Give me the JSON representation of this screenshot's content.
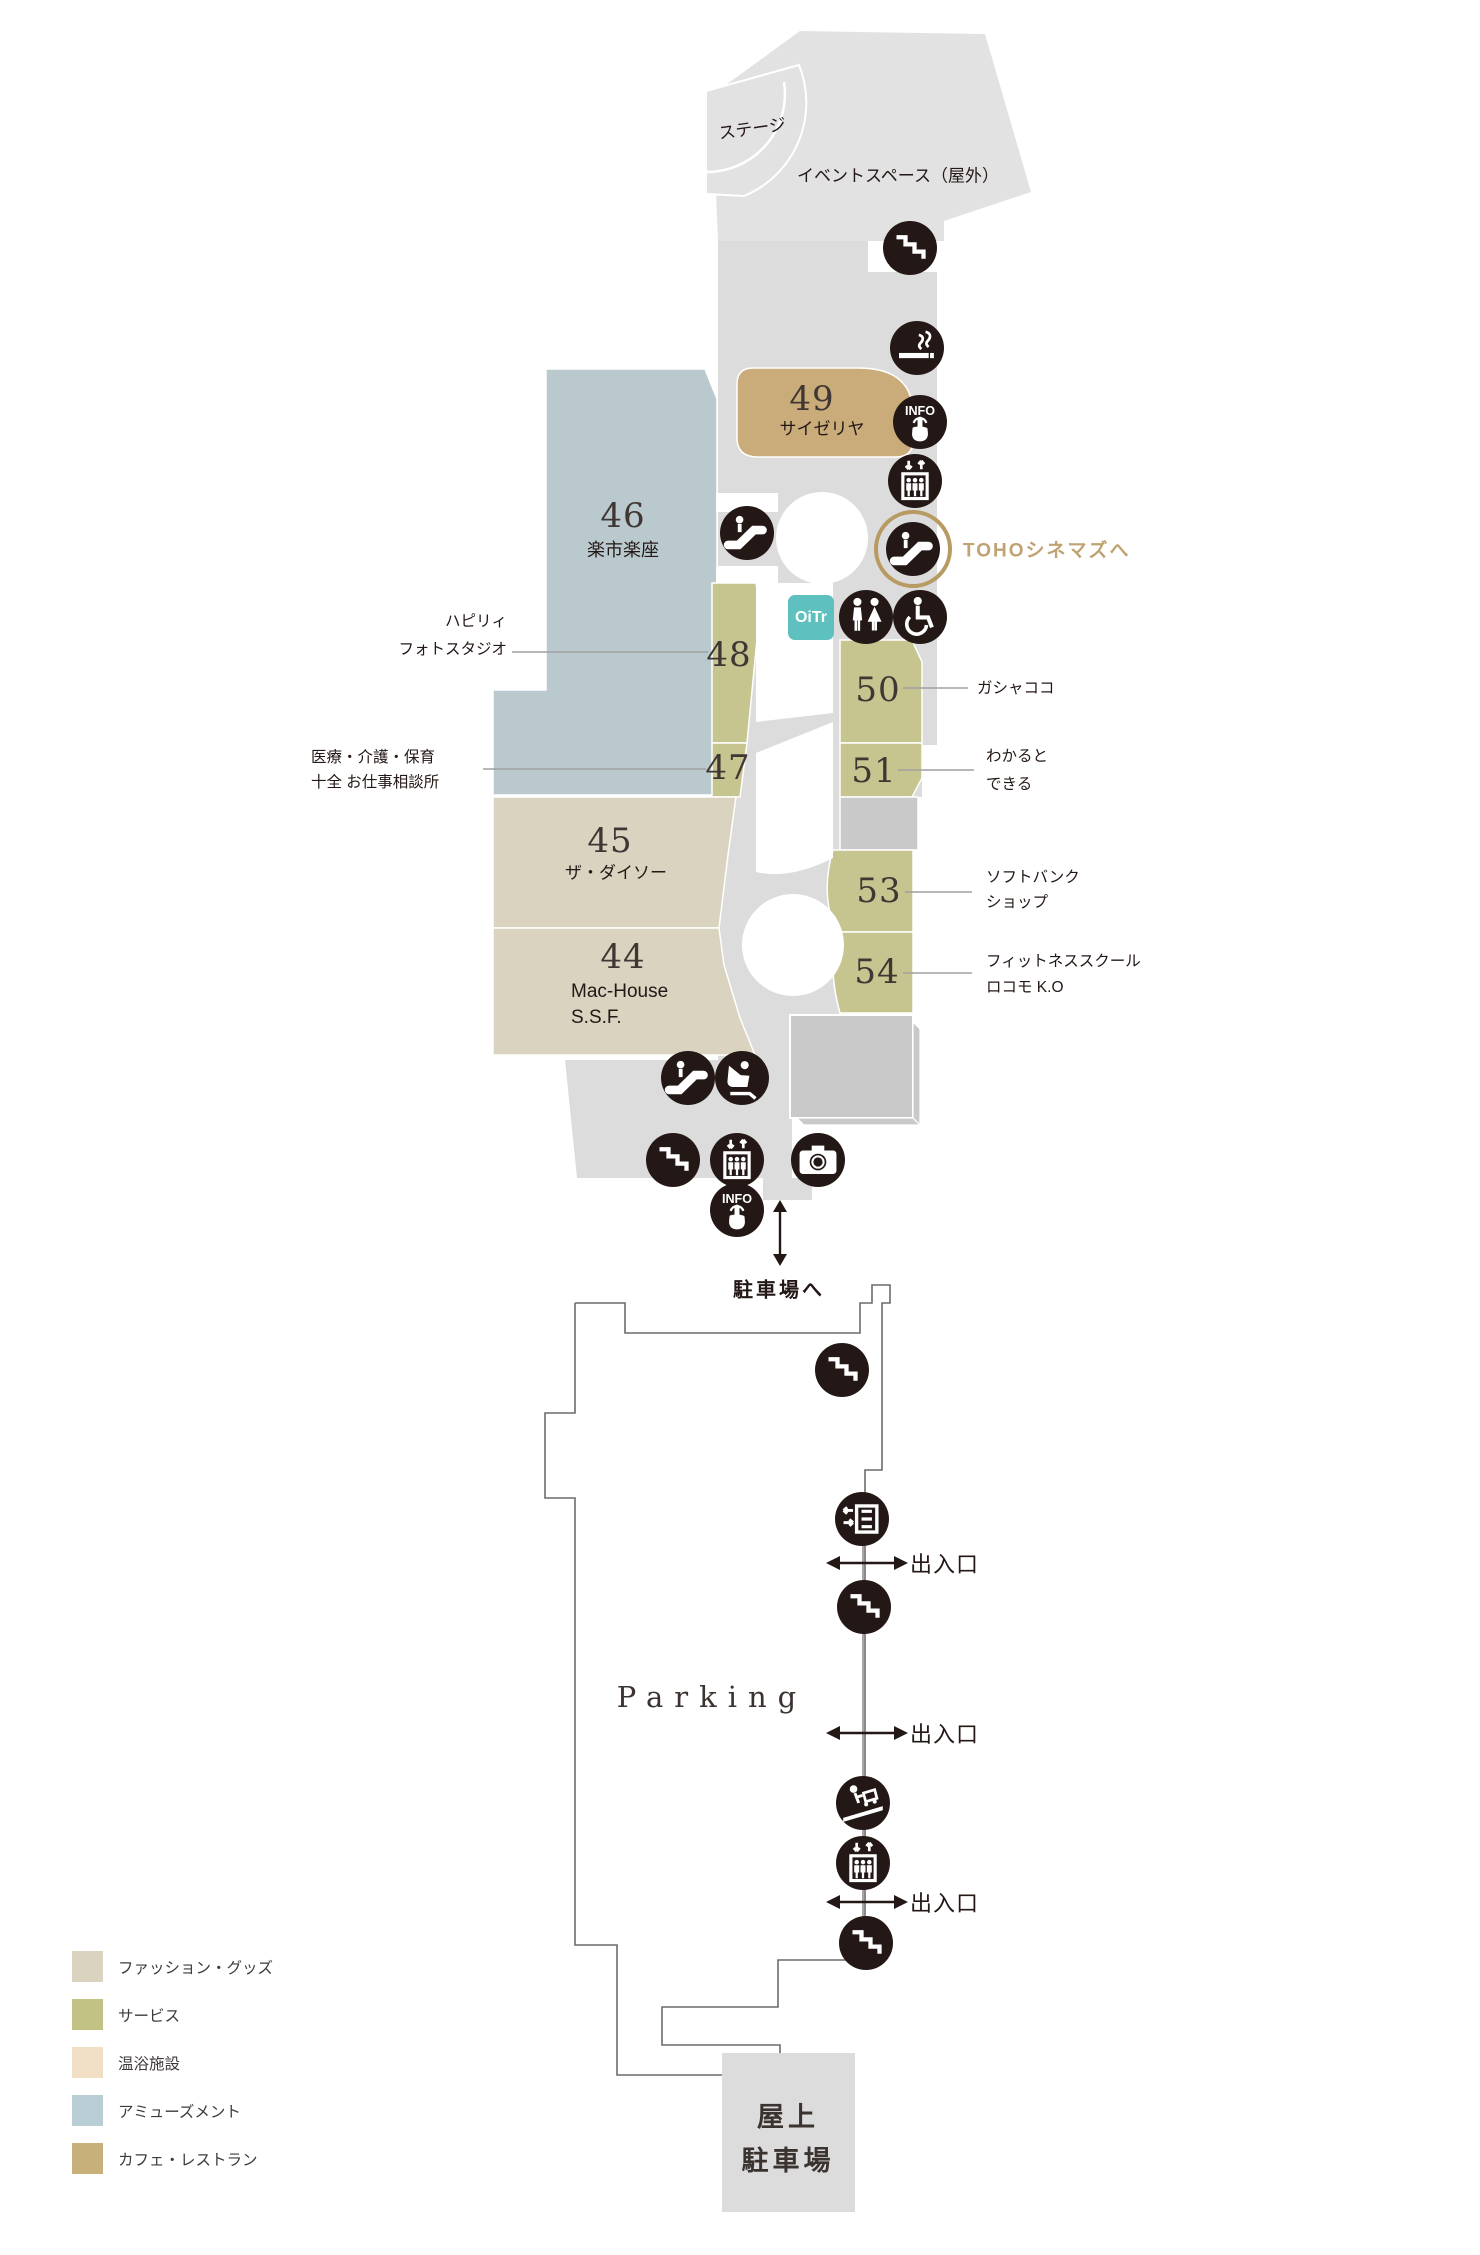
{
  "upper_map": {
    "stage_label": "ステージ",
    "event_space_label": "イベントスペース（屋外）",
    "toho_link_label": "TOHOシネマズへ",
    "oitr_label": "OiTr",
    "parking_link_label": "駐車場へ",
    "shops": {
      "s44": {
        "number": "44",
        "name": "Mac-House",
        "name2": "S.S.F."
      },
      "s45": {
        "number": "45",
        "name": "ザ・ダイソー"
      },
      "s46": {
        "number": "46",
        "name": "楽市楽座"
      },
      "s47": {
        "number": "47"
      },
      "s48": {
        "number": "48"
      },
      "s49": {
        "number": "49",
        "name": "サイゼリヤ"
      },
      "s50": {
        "number": "50"
      },
      "s51": {
        "number": "51"
      },
      "s53": {
        "number": "53"
      },
      "s54": {
        "number": "54"
      }
    },
    "callouts": {
      "happily": {
        "line1": "ハピリィ",
        "line2": "フォトスタジオ"
      },
      "medical": {
        "line1": "医療・介護・保育",
        "line2": "十全 お仕事相談所"
      },
      "gashacoco": {
        "line1": "ガシャココ"
      },
      "wakaru": {
        "line1": "わかると",
        "line2": "できる"
      },
      "softbank": {
        "line1": "ソフトバンク",
        "line2": "ショップ"
      },
      "fitness": {
        "line1": "フィットネススクール",
        "line2": "ロコモ K.O"
      }
    }
  },
  "parking": {
    "title": "Parking",
    "exits": [
      "出入口",
      "出入口",
      "出入口"
    ],
    "rooftop": {
      "line1": "屋上",
      "line2": "駐車場"
    }
  },
  "legend": {
    "items": [
      {
        "label": "ファッション・グッズ",
        "color": "#d9d3c0"
      },
      {
        "label": "サービス",
        "color": "#c2c285"
      },
      {
        "label": "温浴施設",
        "color": "#f0dfc5"
      },
      {
        "label": "アミューズメント",
        "color": "#b9cdd5"
      },
      {
        "label": "カフェ・レストラン",
        "color": "#c8b07b"
      }
    ]
  },
  "icons": [
    {
      "type": "stairs",
      "x": 910,
      "y": 248
    },
    {
      "type": "smoking",
      "x": 917,
      "y": 348
    },
    {
      "type": "info",
      "x": 920,
      "y": 422
    },
    {
      "type": "elevator",
      "x": 915,
      "y": 481
    },
    {
      "type": "escalator",
      "x": 913,
      "y": 549,
      "ring": true
    },
    {
      "type": "escalator",
      "x": 747,
      "y": 533
    },
    {
      "type": "restroom",
      "x": 866,
      "y": 617
    },
    {
      "type": "wheelchair",
      "x": 920,
      "y": 617
    },
    {
      "type": "escalator",
      "x": 688,
      "y": 1078
    },
    {
      "type": "massage-chair",
      "x": 742,
      "y": 1078
    },
    {
      "type": "stairs",
      "x": 673,
      "y": 1160
    },
    {
      "type": "elevator",
      "x": 737,
      "y": 1160
    },
    {
      "type": "camera",
      "x": 818,
      "y": 1160
    },
    {
      "type": "info",
      "x": 737,
      "y": 1210
    },
    {
      "type": "stairs",
      "x": 842,
      "y": 1370
    },
    {
      "type": "parking-gate",
      "x": 862,
      "y": 1519
    },
    {
      "type": "stairs",
      "x": 864,
      "y": 1607
    },
    {
      "type": "cart-slope",
      "x": 863,
      "y": 1803
    },
    {
      "type": "elevator",
      "x": 863,
      "y": 1863
    },
    {
      "type": "stairs",
      "x": 866,
      "y": 1943
    }
  ],
  "colors": {
    "corridor": "#dcdcdd",
    "event_space": "#e2e2e3",
    "block_gray": "#c9c9ca",
    "fashion": "#d9d3c0",
    "service": "#c6c48f",
    "amusement": "#b9c9cd",
    "cafe_restaurant": "#c9ac79",
    "bath": "#f0dfc5",
    "icon_bg": "#231815",
    "accent_tan": "#bfa372",
    "oitr_teal": "#5ec0bf",
    "text_dark": "#3b3330"
  }
}
